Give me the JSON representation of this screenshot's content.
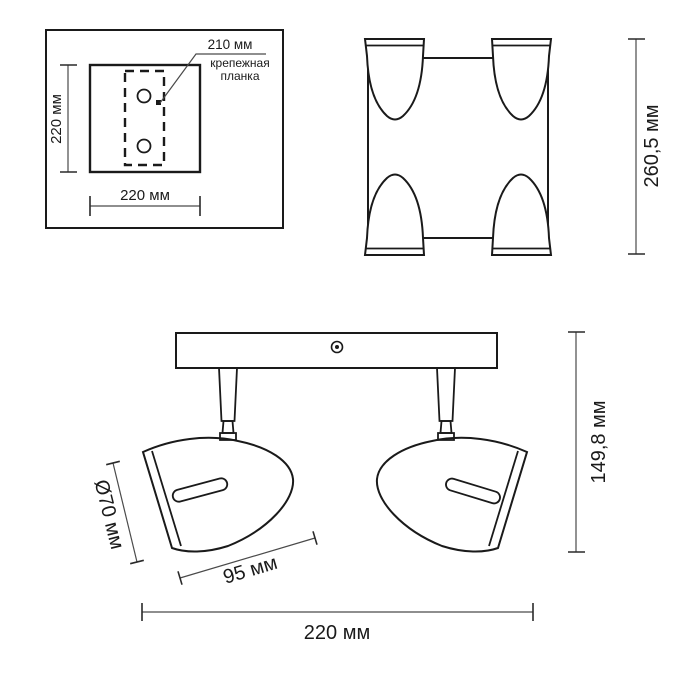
{
  "page": {
    "background": "#ffffff",
    "line_color": "#1a1a1a"
  },
  "mounting_plate_inset": {
    "bracket_width_label": "210 мм",
    "bracket_caption_line1": "крепежная",
    "bracket_caption_line2": "планка",
    "plate_height_label": "220 мм",
    "plate_width_label": "220 мм"
  },
  "top_view": {
    "overall_depth_label": "260,5 мм"
  },
  "side_view": {
    "shade_diameter_label": "Ø70 мм",
    "shade_length_label": "95 мм",
    "overall_height_label": "149,8 мм",
    "base_length_label": "220 мм"
  }
}
